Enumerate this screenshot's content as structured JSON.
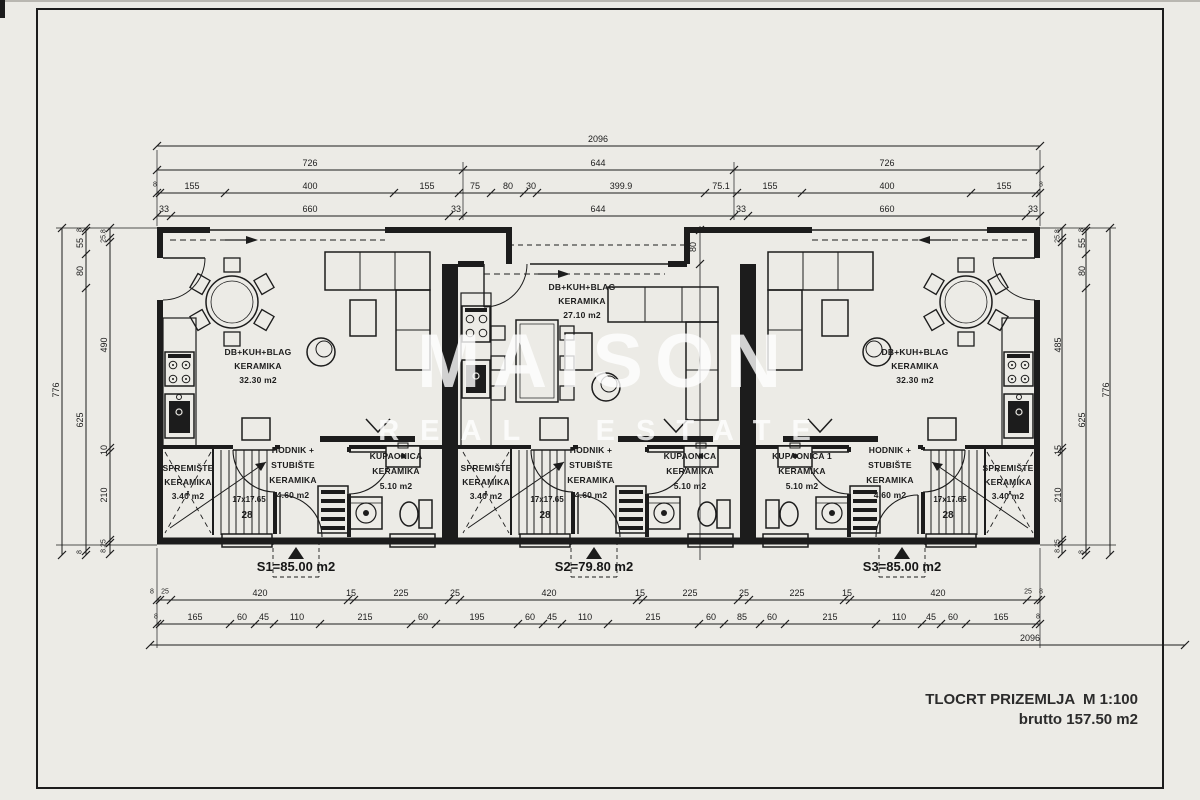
{
  "sheet": {
    "scale_note": "TLOCRT PRIZEMLJA  M 1:100",
    "area_note": "brutto 157.50 m2"
  },
  "watermark": {
    "line1": "MAISON",
    "line2": "REAL ESTATE"
  },
  "ink_color": "#1c1c1c",
  "paper_color": "#ecebe6",
  "units": [
    {
      "id": "S1",
      "area_label": "S1=85.00 m2",
      "living": [
        "DB+KUH+BLAG",
        "KERAMIKA",
        "32.30 m2"
      ],
      "storage": [
        "SPREMIŠTE",
        "KERAMIKA",
        "3.40 m2"
      ],
      "hall": [
        "HODNIK +",
        "STUBIŠTE",
        "KERAMIKA",
        "4.60 m2"
      ],
      "bath": [
        "KUPAONICA",
        "KERAMIKA",
        "5.10 m2"
      ],
      "stairs": [
        "17x17.65",
        "28"
      ]
    },
    {
      "id": "S2",
      "area_label": "S2=79.80 m2",
      "living": [
        "DB+KUH+BLAG",
        "KERAMIKA",
        "27.10 m2"
      ],
      "storage": [
        "SPREMIŠTE",
        "KERAMIKA",
        "3.40 m2"
      ],
      "hall": [
        "HODNIK +",
        "STUBIŠTE",
        "KERAMIKA",
        "4.60 m2"
      ],
      "bath": [
        "KUPAONICA",
        "KERAMIKA",
        "5.10 m2"
      ],
      "stairs": [
        "17x17.65",
        "28"
      ]
    },
    {
      "id": "S3",
      "area_label": "S3=85.00 m2",
      "living": [
        "DB+KUH+BLAG",
        "KERAMIKA",
        "32.30 m2"
      ],
      "storage": [
        "SPREMIŠTE",
        "KERAMIKA",
        "3.40 m2"
      ],
      "hall": [
        "HODNIK +",
        "STUBIŠTE",
        "KERAMIKA",
        "4.60 m2"
      ],
      "bath": [
        "KUPAONICA 1",
        "KERAMIKA",
        "5.10 m2"
      ],
      "stairs": [
        "17x17.65",
        "28"
      ]
    }
  ],
  "dim_labels": [
    {
      "t": "2096",
      "x": 598,
      "y": 139
    },
    {
      "t": "726",
      "x": 310,
      "y": 163
    },
    {
      "t": "644",
      "x": 598,
      "y": 163
    },
    {
      "t": "726",
      "x": 887,
      "y": 163
    },
    {
      "t": "8",
      "x": 155,
      "y": 185,
      "s": 7
    },
    {
      "t": "155",
      "x": 192,
      "y": 186
    },
    {
      "t": "400",
      "x": 310,
      "y": 186
    },
    {
      "t": "155",
      "x": 427,
      "y": 186
    },
    {
      "t": "75",
      "x": 475,
      "y": 186
    },
    {
      "t": "80",
      "x": 508,
      "y": 186
    },
    {
      "t": "30",
      "x": 531,
      "y": 186
    },
    {
      "t": "399.9",
      "x": 621,
      "y": 186
    },
    {
      "t": "75.1",
      "x": 721,
      "y": 186
    },
    {
      "t": "155",
      "x": 770,
      "y": 186
    },
    {
      "t": "400",
      "x": 887,
      "y": 186
    },
    {
      "t": "155",
      "x": 1004,
      "y": 186
    },
    {
      "t": "8",
      "x": 1041,
      "y": 185,
      "s": 7
    },
    {
      "t": "33",
      "x": 164,
      "y": 209
    },
    {
      "t": "660",
      "x": 310,
      "y": 209
    },
    {
      "t": "33",
      "x": 456,
      "y": 209
    },
    {
      "t": "644",
      "x": 598,
      "y": 209
    },
    {
      "t": "33",
      "x": 741,
      "y": 209
    },
    {
      "t": "660",
      "x": 887,
      "y": 209
    },
    {
      "t": "33",
      "x": 1033,
      "y": 209
    },
    {
      "t": "8",
      "x": 152,
      "y": 592,
      "s": 7
    },
    {
      "t": "25",
      "x": 165,
      "y": 592,
      "s": 7
    },
    {
      "t": "420",
      "x": 260,
      "y": 593
    },
    {
      "t": "15",
      "x": 351,
      "y": 593
    },
    {
      "t": "225",
      "x": 401,
      "y": 593
    },
    {
      "t": "25",
      "x": 455,
      "y": 593
    },
    {
      "t": "420",
      "x": 549,
      "y": 593
    },
    {
      "t": "15",
      "x": 640,
      "y": 593
    },
    {
      "t": "225",
      "x": 690,
      "y": 593
    },
    {
      "t": "25",
      "x": 744,
      "y": 593
    },
    {
      "t": "225",
      "x": 797,
      "y": 593
    },
    {
      "t": "15",
      "x": 847,
      "y": 593
    },
    {
      "t": "420",
      "x": 938,
      "y": 593
    },
    {
      "t": "25",
      "x": 1028,
      "y": 592,
      "s": 7
    },
    {
      "t": "8",
      "x": 1041,
      "y": 592,
      "s": 7
    },
    {
      "t": "8",
      "x": 156,
      "y": 617,
      "s": 7
    },
    {
      "t": "165",
      "x": 195,
      "y": 617
    },
    {
      "t": "60",
      "x": 242,
      "y": 617
    },
    {
      "t": "45",
      "x": 264,
      "y": 617
    },
    {
      "t": "110",
      "x": 297,
      "y": 617
    },
    {
      "t": "215",
      "x": 365,
      "y": 617
    },
    {
      "t": "60",
      "x": 423,
      "y": 617
    },
    {
      "t": "195",
      "x": 477,
      "y": 617
    },
    {
      "t": "60",
      "x": 530,
      "y": 617
    },
    {
      "t": "45",
      "x": 552,
      "y": 617
    },
    {
      "t": "110",
      "x": 585,
      "y": 617
    },
    {
      "t": "215",
      "x": 653,
      "y": 617
    },
    {
      "t": "60",
      "x": 711,
      "y": 617
    },
    {
      "t": "85",
      "x": 742,
      "y": 617
    },
    {
      "t": "60",
      "x": 772,
      "y": 617
    },
    {
      "t": "215",
      "x": 830,
      "y": 617
    },
    {
      "t": "110",
      "x": 899,
      "y": 617
    },
    {
      "t": "45",
      "x": 931,
      "y": 617
    },
    {
      "t": "60",
      "x": 953,
      "y": 617
    },
    {
      "t": "165",
      "x": 1001,
      "y": 617
    },
    {
      "t": "8",
      "x": 1038,
      "y": 617,
      "s": 7
    },
    {
      "t": "2096",
      "x": 1030,
      "y": 638
    },
    {
      "t": "776",
      "x": 56,
      "y": 390,
      "r": 1
    },
    {
      "t": "8",
      "x": 80,
      "y": 230,
      "r": 1,
      "s": 7
    },
    {
      "t": "55",
      "x": 80,
      "y": 243,
      "r": 1
    },
    {
      "t": "80",
      "x": 80,
      "y": 271,
      "r": 1
    },
    {
      "t": "625",
      "x": 80,
      "y": 420,
      "r": 1
    },
    {
      "t": "8",
      "x": 80,
      "y": 552,
      "r": 1,
      "s": 7
    },
    {
      "t": "25.8",
      "x": 104,
      "y": 236,
      "r": 1,
      "s": 7
    },
    {
      "t": "490",
      "x": 104,
      "y": 345,
      "r": 1
    },
    {
      "t": "10",
      "x": 104,
      "y": 450,
      "r": 1
    },
    {
      "t": "210",
      "x": 104,
      "y": 495,
      "r": 1
    },
    {
      "t": "8.25",
      "x": 104,
      "y": 546,
      "r": 1,
      "s": 7
    },
    {
      "t": "25.8",
      "x": 1058,
      "y": 236,
      "r": 1,
      "s": 7
    },
    {
      "t": "485",
      "x": 1058,
      "y": 345,
      "r": 1
    },
    {
      "t": "15",
      "x": 1058,
      "y": 450,
      "r": 1
    },
    {
      "t": "210",
      "x": 1058,
      "y": 495,
      "r": 1
    },
    {
      "t": "8.25",
      "x": 1058,
      "y": 546,
      "r": 1,
      "s": 7
    },
    {
      "t": "8",
      "x": 1082,
      "y": 230,
      "r": 1,
      "s": 7
    },
    {
      "t": "55",
      "x": 1082,
      "y": 243,
      "r": 1
    },
    {
      "t": "80",
      "x": 1082,
      "y": 271,
      "r": 1
    },
    {
      "t": "625",
      "x": 1082,
      "y": 420,
      "r": 1
    },
    {
      "t": "8",
      "x": 1082,
      "y": 552,
      "r": 1,
      "s": 7
    },
    {
      "t": "776",
      "x": 1106,
      "y": 390,
      "r": 1
    },
    {
      "t": "80",
      "x": 693,
      "y": 247,
      "r": 1
    }
  ]
}
